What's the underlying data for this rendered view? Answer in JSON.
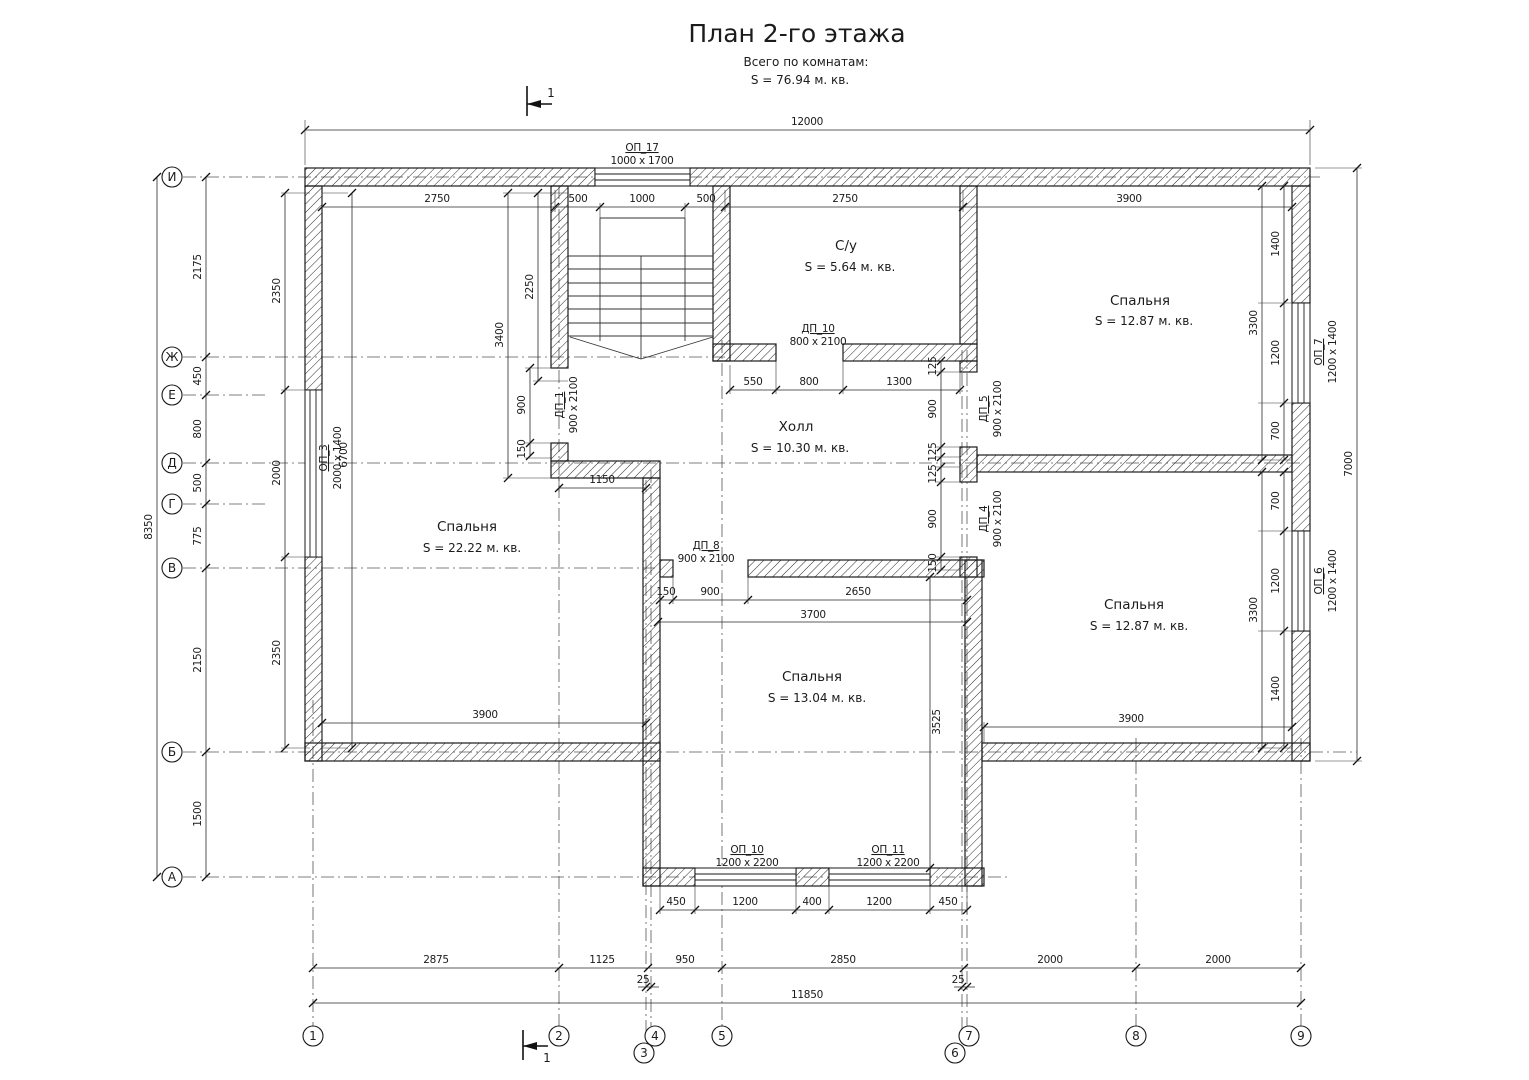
{
  "header": {
    "title": "План 2-го этажа",
    "subtitle": "Всего по комнатам:",
    "total": "S = 76.94 м. кв."
  },
  "section": {
    "label": "1"
  },
  "axes": {
    "rows": [
      "И",
      "Ж",
      "Е",
      "Д",
      "Г",
      "В",
      "Б",
      "А"
    ],
    "cols": [
      "1",
      "2",
      "3",
      "4",
      "5",
      "6",
      "7",
      "8",
      "9"
    ]
  },
  "rooms": [
    {
      "name": "С/у",
      "area": "S = 5.64 м. кв."
    },
    {
      "name": "Спальня",
      "area": "S = 12.87 м. кв."
    },
    {
      "name": "Холл",
      "area": "S = 10.30 м. кв."
    },
    {
      "name": "Спальня",
      "area": "S = 22.22 м. кв."
    },
    {
      "name": "Спальня",
      "area": "S = 12.87 м. кв."
    },
    {
      "name": "Спальня",
      "area": "S = 13.04 м. кв."
    }
  ],
  "openings": {
    "op17": {
      "name": "ОП_17",
      "size": "1000 х 1700"
    },
    "op3": {
      "name": "ОП_3",
      "size": "2000 х 1400"
    },
    "op7": {
      "name": "ОП_7",
      "size": "1200 х 1400"
    },
    "op6": {
      "name": "ОП_6",
      "size": "1200 х 1400"
    },
    "op10": {
      "name": "ОП_10",
      "size": "1200 х 2200"
    },
    "op11": {
      "name": "ОП_11",
      "size": "1200 х 2200"
    },
    "dp1": {
      "name": "ДП_1",
      "size": "900 х 2100"
    },
    "dp10": {
      "name": "ДП_10",
      "size": "800 х 2100"
    },
    "dp5": {
      "name": "ДП_5",
      "size": "900 х 2100"
    },
    "dp4": {
      "name": "ДП_4",
      "size": "900 х 2100"
    },
    "dp8": {
      "name": "ДП_8",
      "size": "900 х 2100"
    }
  },
  "dims": [
    "12000",
    "2750",
    "500",
    "1000",
    "500",
    "2750",
    "3900",
    "550",
    "800",
    "1300",
    "1150",
    "150",
    "900",
    "2650",
    "3700",
    "3900",
    "3900",
    "450",
    "1200",
    "400",
    "1200",
    "450",
    "2875",
    "1125",
    "950",
    "2850",
    "2000",
    "2000",
    "25",
    "25",
    "11850",
    "2175",
    "450",
    "800",
    "500",
    "775",
    "2150",
    "1500",
    "8350",
    "2350",
    "2000",
    "2350",
    "6700",
    "2250",
    "3400",
    "900",
    "150",
    "125",
    "900",
    "125",
    "125",
    "900",
    "150",
    "1400",
    "1200",
    "700",
    "3300",
    "700",
    "1200",
    "1400",
    "3300",
    "3525",
    "7000"
  ]
}
